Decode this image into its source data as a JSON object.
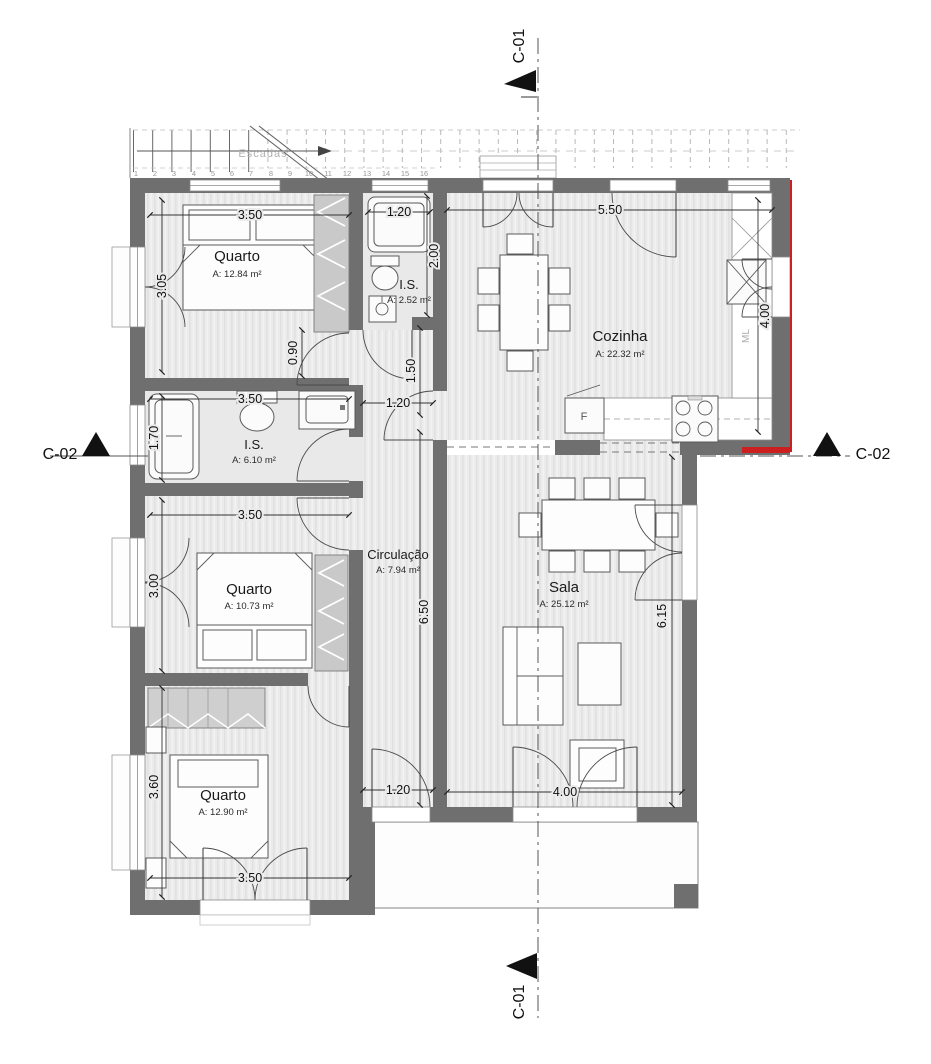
{
  "drawing": {
    "kind": "floor-plan"
  },
  "colors": {
    "wall": "#6f6f6f",
    "floor": "#ebebeb",
    "accent_red": "#cc2020"
  },
  "sections": {
    "c01": "C-01",
    "c02": "C-02"
  },
  "stairs": {
    "label": "Escadas",
    "treads": [
      "1",
      "2",
      "3",
      "4",
      "5",
      "6",
      "7",
      "8",
      "9",
      "10",
      "11",
      "12",
      "13",
      "14",
      "15",
      "16"
    ]
  },
  "rooms": {
    "quarto1": {
      "name": "Quarto",
      "area": "A: 12.84 m²"
    },
    "is1": {
      "name": "I.S.",
      "area": "A: 2.52 m²"
    },
    "cozinha": {
      "name": "Cozinha",
      "area": "A: 22.32 m²"
    },
    "is2": {
      "name": "I.S.",
      "area": "A: 6.10 m²"
    },
    "quarto2": {
      "name": "Quarto",
      "area": "A: 10.73 m²"
    },
    "circulacao": {
      "name": "Circulação",
      "area": "A: 7.94 m²"
    },
    "sala": {
      "name": "Sala",
      "area": "A: 25.12 m²"
    },
    "quarto3": {
      "name": "Quarto",
      "area": "A: 12.90 m²"
    }
  },
  "appliances": {
    "fridge": "F",
    "washing_machine": "ML"
  },
  "dimensions": {
    "q1_w": "3.50",
    "q1_h": "3.05",
    "is1_w": "1.20",
    "is1_h": "2.00",
    "koz_w": "5.50",
    "koz_h": "4.00",
    "hall_v": "0.90",
    "hall_v2": "1.50",
    "hall_w": "1.20",
    "is2_w": "3.50",
    "is2_h": "1.70",
    "q2_w": "3.50",
    "q2_h": "3.00",
    "circ_l": "6.50",
    "sala_h": "6.15",
    "sala_w": "4.00",
    "q3_h": "3.60",
    "q3_w": "3.50",
    "exit_w": "1.20"
  }
}
